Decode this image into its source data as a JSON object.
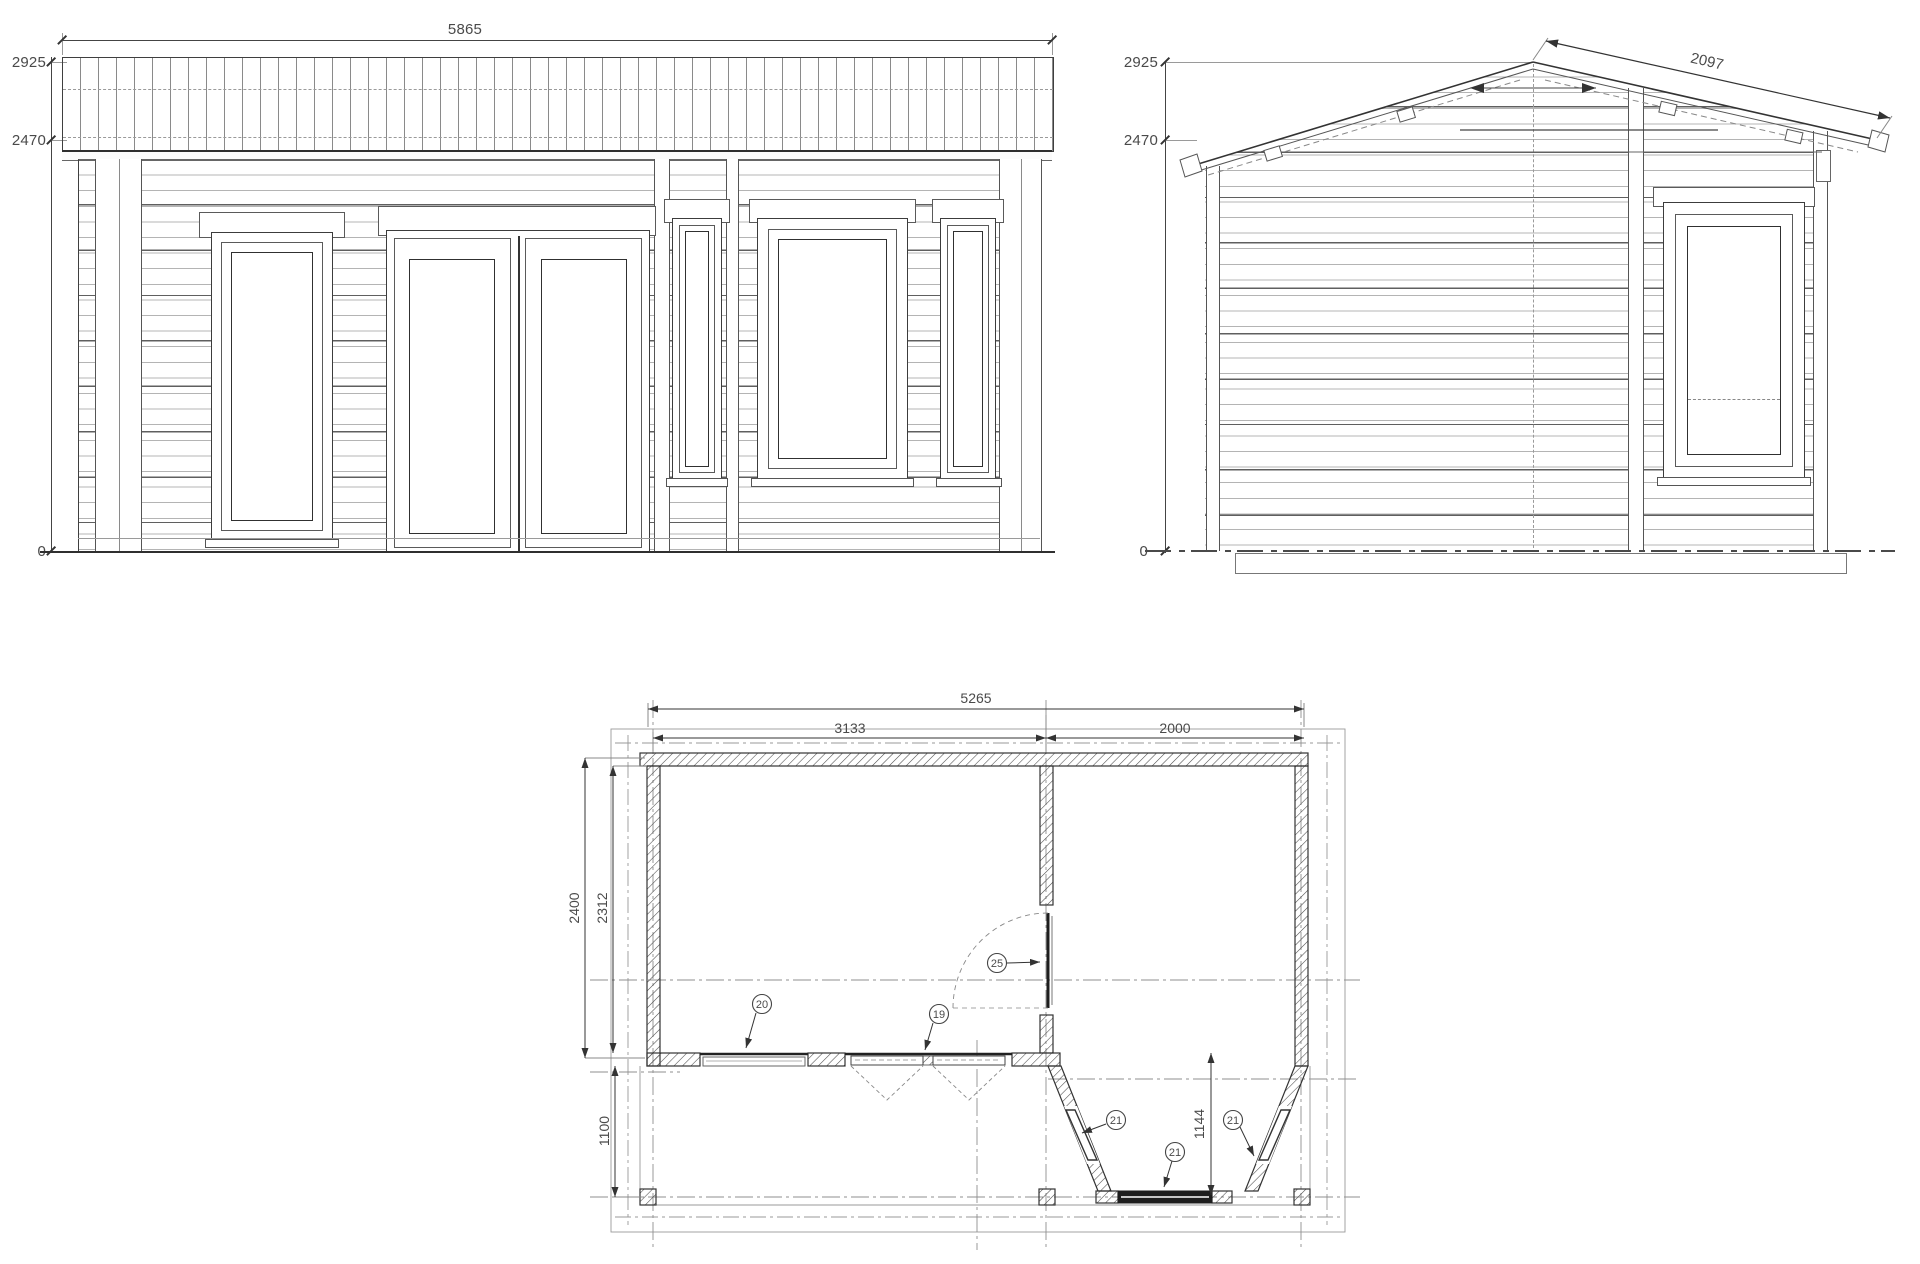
{
  "front_elevation": {
    "dims": {
      "width": "5865",
      "ridge_height": "2925",
      "eave_height": "2470",
      "ground": "0"
    }
  },
  "side_elevation": {
    "dims": {
      "ridge_height": "2925",
      "eave_height": "2470",
      "ground": "0",
      "roof_slope_length": "2097"
    }
  },
  "floor_plan": {
    "dims": {
      "overall_width": "5265",
      "main_room_width": "3133",
      "veranda_width": "2000",
      "overall_depth": "2400",
      "main_room_depth": "2312",
      "terrace_depth": "1100",
      "bay_depth": "1144"
    },
    "callouts": [
      {
        "label": "20"
      },
      {
        "label": "19"
      },
      {
        "label": "25"
      },
      {
        "label": "21"
      },
      {
        "label": "21"
      },
      {
        "label": "21"
      }
    ]
  }
}
